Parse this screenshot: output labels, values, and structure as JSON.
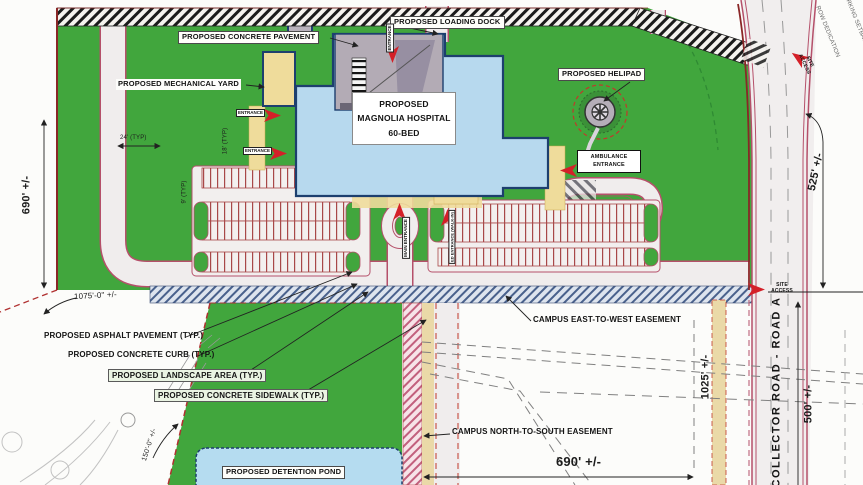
{
  "drawing": {
    "type": "civil site plan",
    "facility": "PROPOSED MAGNOLIA HOSPITAL 60-BED"
  },
  "labels": {
    "concrete_pavement": "PROPOSED CONCRETE PAVEMENT",
    "loading_dock": "PROPOSED LOADING DOCK",
    "mechanical_yard": "PROPOSED MECHANICAL YARD",
    "helipad": "PROPOSED HELIPAD",
    "hospital_l1": "PROPOSED",
    "hospital_l2": "MAGNOLIA HOSPITAL",
    "hospital_l3": "60-BED",
    "ambulance_l1": "AMBULANCE",
    "ambulance_l2": "ENTRANCE",
    "east_west_easement": "CAMPUS EAST-TO-WEST EASEMENT",
    "north_south_easement": "CAMPUS NORTH-TO-SOUTH EASEMENT",
    "asphalt": "PROPOSED ASPHALT PAVEMENT (TYP.)",
    "curb": "PROPOSED CONCRETE CURB (TYP.)",
    "landscape": "PROPOSED LANDSCAPE AREA (TYP.)",
    "sidewalk": "PROPOSED CONCRETE SIDEWALK (TYP.)",
    "detention_pond": "PROPOSED DETENTION POND",
    "collector_road": "COLLECTOR ROAD - ROAD A",
    "row_dedication": "ROW DEDICATION",
    "parking_setback": "PARKING SETBACK"
  },
  "entrances": {
    "entrance": "ENTRANCE",
    "main": "MAIN ENTRANCE",
    "ed": "ED ENTRANCE (WALK-IN)",
    "site_access": "SITE ACCESS"
  },
  "dims": {
    "west": "690' +/-",
    "south": "690' +/-",
    "northeast": "525' +/-",
    "east_upper": "1025' +/-",
    "east_lower": "500' +/-",
    "drive_length": "1075'-0\" +/-",
    "pond": "150'-0\" +/-",
    "aisle": "24' (TYP)",
    "stall_depth": "18' (TYP)",
    "stall_width": "9' (TYP)"
  },
  "colors": {
    "grass": "#41a63d",
    "building": "#b7d9ee",
    "pond": "#b5dcf0",
    "canopy": "#efdc9b",
    "concrete": "#b3abb5",
    "curb_red": "#b5506a",
    "boundary_red": "#8a2727",
    "arrow_red": "#d42028"
  }
}
